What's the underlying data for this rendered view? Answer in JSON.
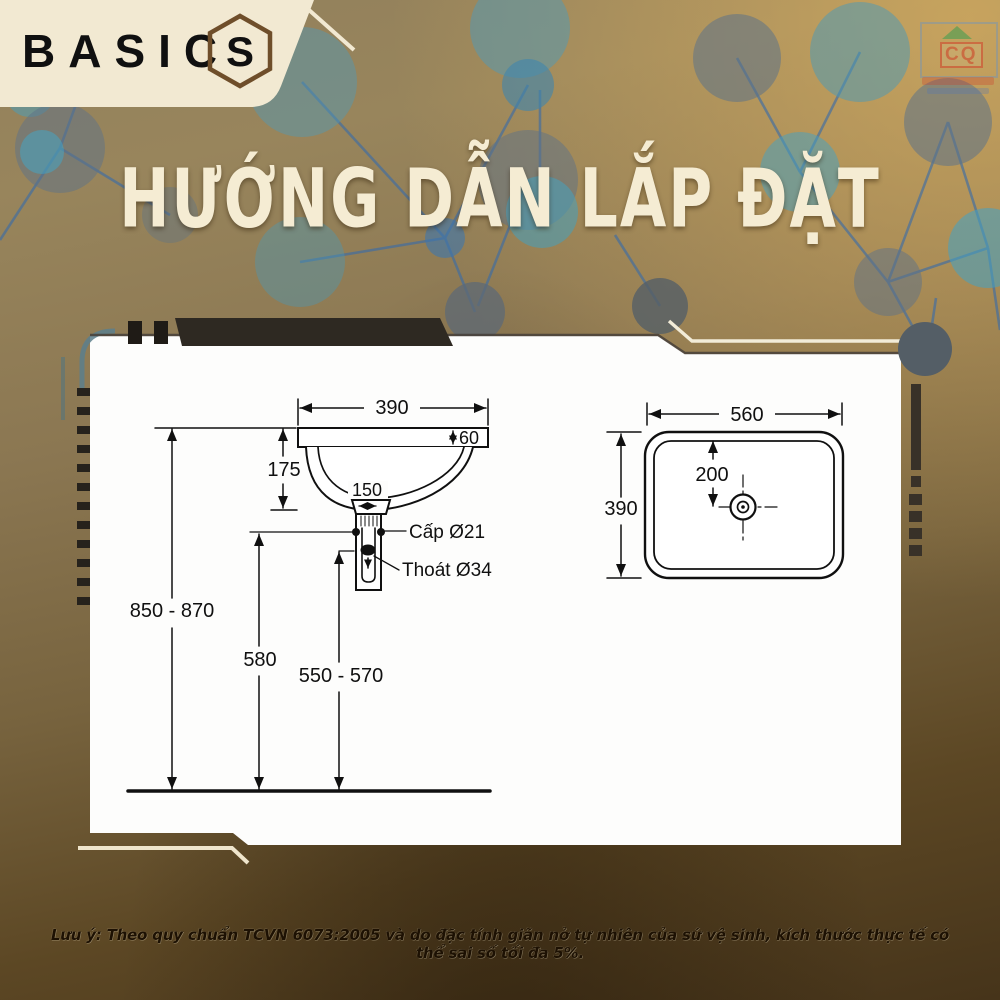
{
  "brand": {
    "name": "BASIC",
    "logo_letter": "S"
  },
  "watermark": {
    "letters": "CQ"
  },
  "page_title": "HƯỚNG DẪN LẮP ĐẶT",
  "note": "Lưu ý: Theo quy chuẩn TCVN 6073:2005 và do đặc tính giãn nở tự nhiên của sứ vệ sinh, kích thước thực tế có thể sai số tối đa 5%.",
  "side_view": {
    "rim_width": "390",
    "rim_thickness": "60",
    "bowl_depth": "175",
    "drain_span": "150",
    "supply_label": "Cấp Ø21",
    "drain_label": "Thoát Ø34",
    "rim_height_range": "850 - 870",
    "supply_height": "580",
    "drain_height_range": "550 - 570"
  },
  "top_view": {
    "basin_width": "560",
    "basin_depth": "390",
    "hole_offset": "200"
  },
  "colors": {
    "background_top": "#92805c",
    "background_bottom": "#46341a",
    "accent_cream": "#f2e9d2",
    "brand_brown": "#6f4e2a",
    "panel_white": "#fdfdfc",
    "node_blue": "#4d9cbd",
    "node_slate": "#5c7086",
    "line_blue": "#3a6ca8"
  }
}
